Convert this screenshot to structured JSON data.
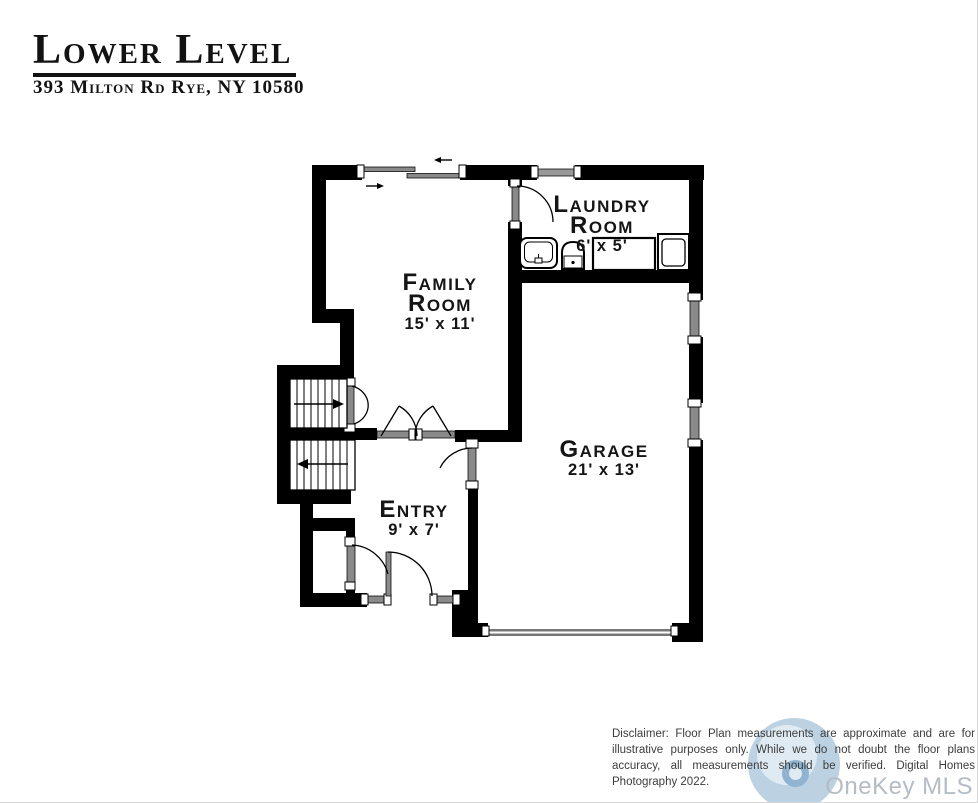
{
  "header": {
    "title": "Lower Level",
    "address": "393 Milton Rd Rye, NY 10580"
  },
  "floor_plan": {
    "rooms": [
      {
        "name": "Family Room",
        "dimensions": "15' x 11'"
      },
      {
        "name": "Laundry Room",
        "dimensions": "6' x 5'"
      },
      {
        "name": "Garage",
        "dimensions": "21' x 13'"
      },
      {
        "name": "Entry",
        "dimensions": "9' x 7'"
      }
    ],
    "features": [
      "sliding-door",
      "windows",
      "laundry-sink",
      "water-heater",
      "washer-dryer",
      "stairs-up",
      "stairs-down",
      "closet",
      "entry-door",
      "garage-door"
    ]
  },
  "footer": {
    "disclaimer": "Disclaimer: Floor Plan measurements are approximate and are for illustrative purposes only. While we do not doubt the floor plans accuracy, all measurements should be verified. Digital Homes Photography 2022.",
    "watermark": "OneKey MLS"
  },
  "colors": {
    "wall_black": "#000000",
    "opening_gray": "#8a8a8a",
    "watermark_gray": "#b4bcc4",
    "logo_blue": "#bcd1e1"
  }
}
